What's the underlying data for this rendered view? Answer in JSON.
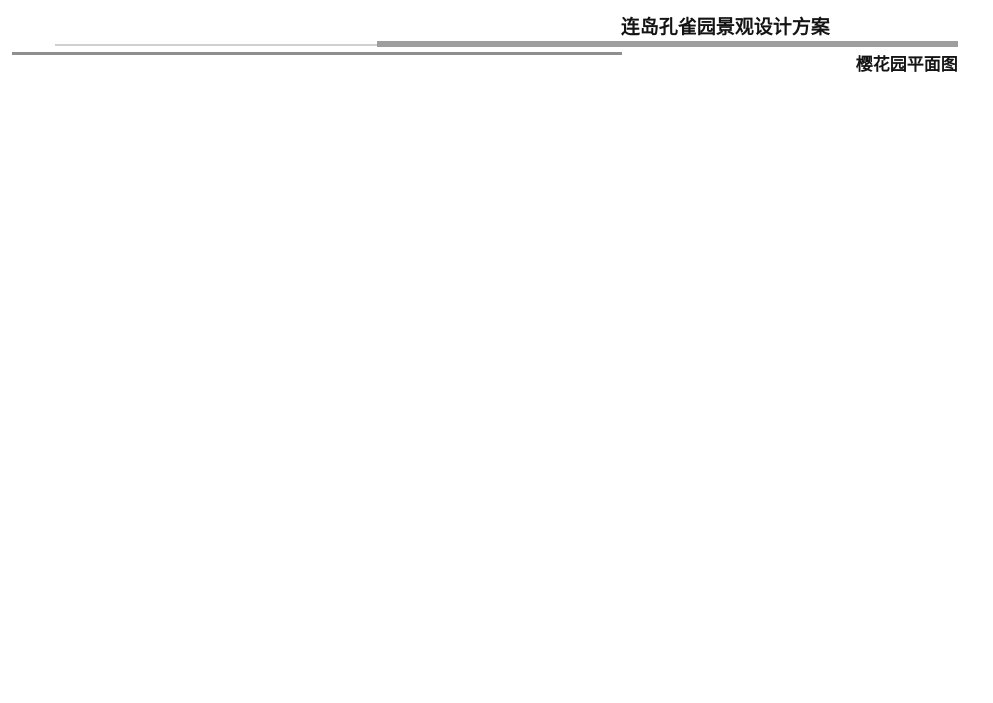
{
  "header": {
    "title": "连岛孔雀园景观设计方案",
    "subtitle": "樱花园平面图"
  },
  "legend": {
    "items": [
      {
        "num": "1",
        "label": "停车位"
      },
      {
        "num": "2",
        "label": "吊桥"
      },
      {
        "num": "3",
        "label": "观海亭"
      },
      {
        "num": "4",
        "label": "休憩空间"
      },
      {
        "num": "5",
        "label": "休憩平台"
      },
      {
        "num": "6",
        "label": "平桥"
      },
      {
        "num": "7",
        "label": "木平台"
      },
      {
        "num": "8",
        "label": "樱花林"
      }
    ]
  },
  "map": {
    "labels": [
      "吊桥",
      "观海亭",
      "休憩空间",
      "休憩平台",
      "平桥",
      "木平台"
    ],
    "watermark": {
      "cn": "清怡景观",
      "en": "LANDSCAPE DESIGN"
    }
  },
  "footer": {
    "text": "LIANDAO KONGQUEYUAN JINGGUAN SHEJI FANGAN"
  },
  "colors": {
    "water_deep": "#20304d",
    "water_mid": "#33496b",
    "water_light": "#48617e",
    "coast_band": "#8f9c6a",
    "terrain": "#84ad5d",
    "terrain_light": "#96be6f",
    "contour": "#2e4016",
    "road": "#5a5d60",
    "road_edge": "#45484b",
    "path": "#dedbd0",
    "path_edge": "#a9a99b",
    "parking": "#a6c2ab",
    "cherry": "#c697a1",
    "cherry_dark": "#9a6c78",
    "tree_green": "#74a048",
    "tree_dark": "#39571f",
    "marker_fill": "#c05050",
    "marker_border": "#8e2e2e",
    "legend_dot": "#c8807e",
    "legend_dot_border": "#9c4a48",
    "bridge": "#8a6148",
    "wood": "#a8784e",
    "structure": "#3d4238",
    "footer_segments": [
      "#56c189",
      "#8ccd74",
      "#b7ddae",
      "#eaf2dd"
    ]
  }
}
